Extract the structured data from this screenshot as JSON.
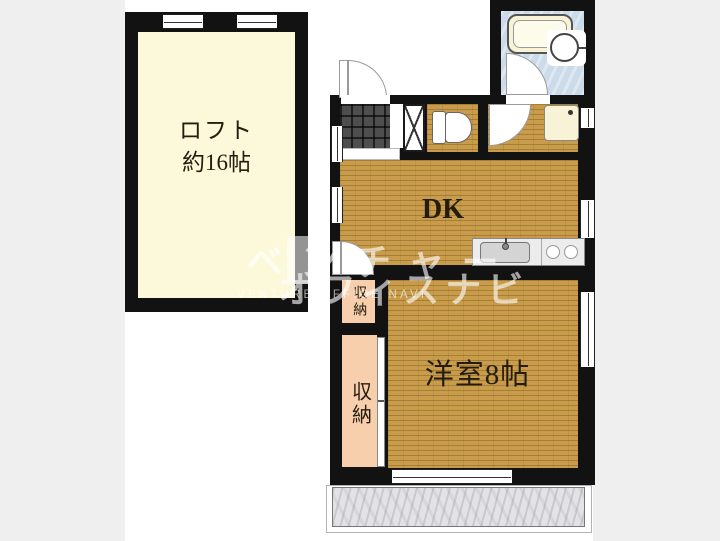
{
  "colors": {
    "page-bg": "#efefef",
    "photo-bg": "#ffffff",
    "wall": "#121212",
    "wood": "#c89c4b",
    "loft-fill": "#fbf9d9",
    "closet-fill": "#f7cfad",
    "bath-fill": "#ccdbe9",
    "tile-dark": "#4e4e4e",
    "balcony-fill": "#e3e3e5",
    "counter-fill": "#ececec",
    "fixture-cream": "#f8f3d6",
    "label-ink": "#241c0e"
  },
  "loft": {
    "name_line": "ロフト",
    "size_line": "約16帖"
  },
  "rooms": {
    "dk_label": "DK",
    "bedroom_label": "洋室8帖",
    "closet_upper_label": "収納",
    "closet_lower_label": "収納"
  },
  "watermark": {
    "brand_line1": "ベンチャー",
    "brand_line2": "オフィスナビ",
    "brand_line3": "VENTURE OFFICE NAVI"
  }
}
